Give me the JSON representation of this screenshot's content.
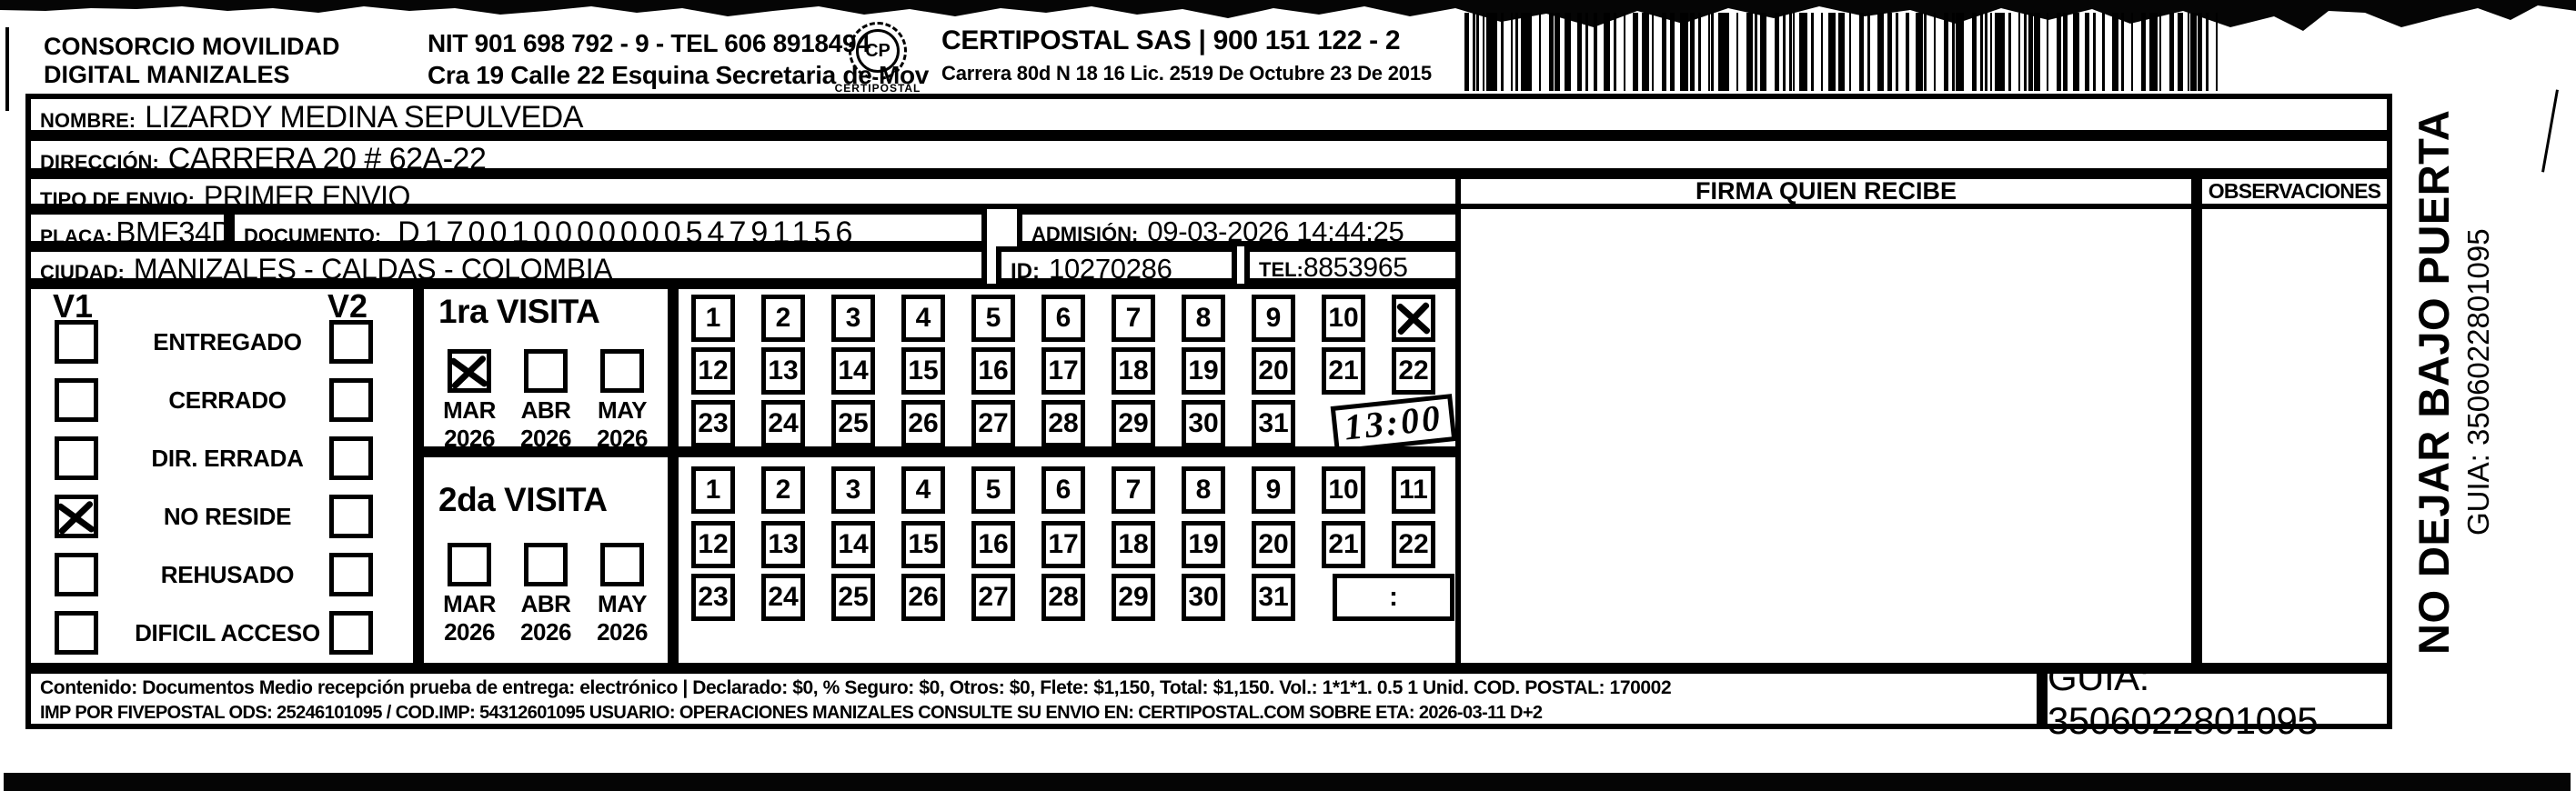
{
  "header": {
    "company_left": {
      "line1": "CONSORCIO MOVILIDAD",
      "line2": "DIGITAL MANIZALES"
    },
    "company_left_info": {
      "line1": "NIT 901 698 792 - 9 - TEL 606 8918494",
      "line2": "Cra 19 Calle 22 Esquina Secretaria de Mov"
    },
    "logo": {
      "icon": "certipostal-logo",
      "monogram": "CP",
      "caption": "CERTIPOSTAL"
    },
    "company_right": {
      "line1": "CERTIPOSTAL SAS | 900 151 122 - 2",
      "line2": "Carrera 80d N 18 16  Lic. 2519 De Octubre 23 De 2015"
    },
    "barcode_icon": "barcode"
  },
  "recipient": {
    "nombre_label": "NOMBRE:",
    "nombre": "LIZARDY MEDINA SEPULVEDA",
    "direccion_label": "DIRECCIÓN:",
    "direccion": "CARRERA 20  #  62A-22",
    "tipo_envio_label": "TIPO DE ENVIO:",
    "tipo_envio": "PRIMER ENVIO",
    "placa_label": "PLACA:",
    "placa": "BMF34D",
    "documento_label": "DOCUMENTO:",
    "documento": "D17001000000054791156",
    "admision_label": "ADMISIÓN:",
    "admision": "09-03-2026 14:44:25",
    "ciudad_label": "CIUDAD:",
    "ciudad": "MANIZALES - CALDAS - COLOMBIA",
    "id_label": "ID:",
    "id": "10270286",
    "tel_label": "TEL:",
    "tel": "8853965"
  },
  "columns": {
    "firma_header": "FIRMA QUIEN RECIBE",
    "observaciones_header": "OBSERVACIONES"
  },
  "status_panel": {
    "v1_label": "V1",
    "v2_label": "V2",
    "options": [
      {
        "label": "ENTREGADO",
        "v1_checked": false,
        "v2_checked": false
      },
      {
        "label": "CERRADO",
        "v1_checked": false,
        "v2_checked": false
      },
      {
        "label": "DIR. ERRADA",
        "v1_checked": false,
        "v2_checked": false
      },
      {
        "label": "NO RESIDE",
        "v1_checked": true,
        "v2_checked": false
      },
      {
        "label": "REHUSADO",
        "v1_checked": false,
        "v2_checked": false
      },
      {
        "label": "DIFICIL ACCESO",
        "v1_checked": false,
        "v2_checked": false
      }
    ]
  },
  "visits": [
    {
      "title": "1ra VISITA",
      "months": [
        {
          "month": "MAR",
          "year": "2026",
          "checked": true
        },
        {
          "month": "ABR",
          "year": "2026",
          "checked": false
        },
        {
          "month": "MAY",
          "year": "2026",
          "checked": false
        }
      ],
      "day_rows": [
        [
          1,
          2,
          3,
          4,
          5,
          6,
          7,
          8,
          9,
          10,
          11
        ],
        [
          12,
          13,
          14,
          15,
          16,
          17,
          18,
          19,
          20,
          21,
          22
        ],
        [
          23,
          24,
          25,
          26,
          27,
          28,
          29,
          30,
          31
        ]
      ],
      "crossed_days": [
        11
      ],
      "time_box": {
        "value": "13:00",
        "handwritten": true
      }
    },
    {
      "title": "2da VISITA",
      "months": [
        {
          "month": "MAR",
          "year": "2026",
          "checked": false
        },
        {
          "month": "ABR",
          "year": "2026",
          "checked": false
        },
        {
          "month": "MAY",
          "year": "2026",
          "checked": false
        }
      ],
      "day_rows": [
        [
          1,
          2,
          3,
          4,
          5,
          6,
          7,
          8,
          9,
          10,
          11
        ],
        [
          12,
          13,
          14,
          15,
          16,
          17,
          18,
          19,
          20,
          21,
          22
        ],
        [
          23,
          24,
          25,
          26,
          27,
          28,
          29,
          30,
          31
        ]
      ],
      "crossed_days": [],
      "time_box": {
        "value": ":",
        "handwritten": false
      }
    }
  ],
  "footer": {
    "line1": "Contenido: Documentos Medio recepción prueba de entrega: electrónico | Declarado: $0, % Seguro: $0, Otros: $0, Flete: $1,150, Total: $1,150. Vol.: 1*1*1. 0.5  1 Unid. COD. POSTAL: 170002",
    "line2": "IMP POR FIVEPOSTAL ODS: 25246101095 / COD.IMP: 54312601095 USUARIO: OPERACIONES MANIZALES CONSULTE SU ENVIO EN: CERTIPOSTAL.COM SOBRE ETA: 2026-03-11 D+2",
    "guia": "GUIA: 3506022801095"
  },
  "side_note": {
    "line1": "NO DEJAR BAJO PUERTA",
    "line2": "GUIA: 3506022801095"
  }
}
